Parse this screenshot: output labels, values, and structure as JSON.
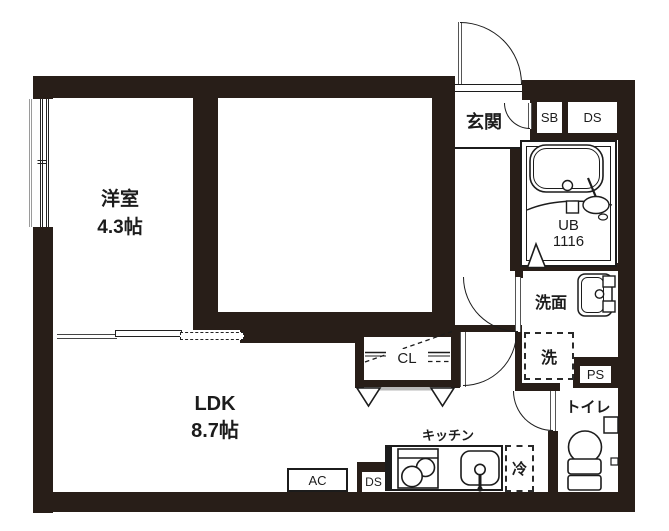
{
  "plan": {
    "rooms": {
      "bedroom": {
        "name": "洋室",
        "size": "4.3帖"
      },
      "ldk": {
        "name": "LDK",
        "size": "8.7帖"
      },
      "entrance": {
        "name": "玄関"
      },
      "washroom": {
        "name": "洗面"
      },
      "toilet": {
        "name": "トイレ"
      },
      "kitchen": {
        "name": "キッチン"
      }
    },
    "labels": {
      "unit_bath_line1": "UB",
      "unit_bath_line2": "1116",
      "shoe_box": "SB",
      "duct_space_top": "DS",
      "duct_space_bottom": "DS",
      "pipe_space": "PS",
      "washing_machine": "洗",
      "refrigerator": "冷",
      "air_conditioner": "AC",
      "closet": "CL"
    },
    "colors": {
      "wall": "#281e18",
      "line": "#1c1c1c"
    }
  }
}
